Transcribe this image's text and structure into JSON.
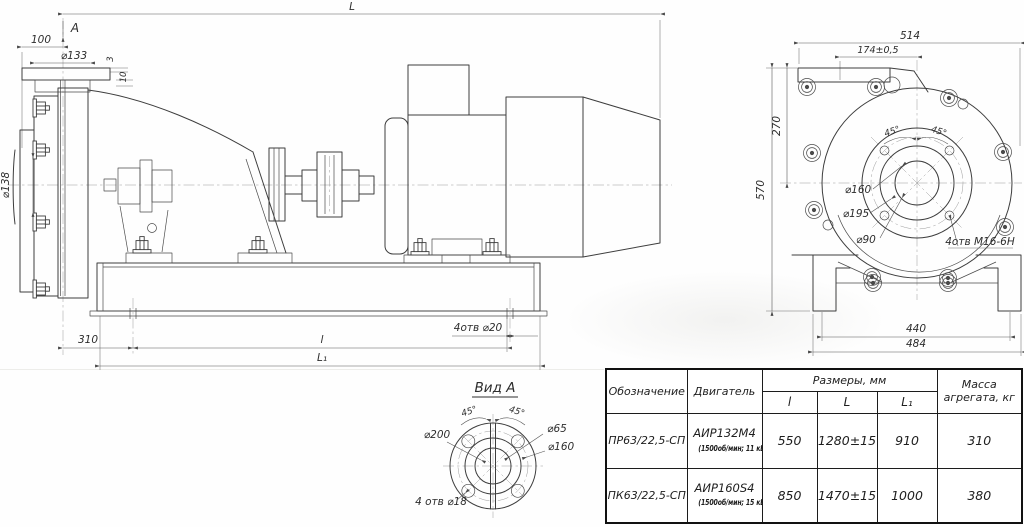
{
  "side_view": {
    "dim_L": "L",
    "view_arrow_label": "А",
    "dim_100": "100",
    "dim_d133": "⌀133",
    "dim_3": "3",
    "dim_10": "10",
    "dim_d138": "⌀138",
    "dim_310": "310",
    "dim_l": "l",
    "dim_L1": "L₁",
    "dim_holes": "4отв ⌀20"
  },
  "front_view": {
    "dim_514": "514",
    "dim_174": "174±0,5",
    "dim_270": "270",
    "dim_570": "570",
    "dim_440": "440",
    "dim_484": "484",
    "dim_d160": "⌀160",
    "dim_d195": "⌀195",
    "dim_d90": "⌀90",
    "dim_45_left": "45°",
    "dim_45_right": "45°",
    "dim_holes": "4отв М16-6Н"
  },
  "view_a": {
    "title": "Вид А",
    "dim_45_left": "45°",
    "dim_45_right": "45°",
    "dim_d200": "⌀200",
    "dim_d65": "⌀65",
    "dim_d160": "⌀160",
    "dim_holes": "4 отв ⌀18"
  },
  "table": {
    "col_designation": "Обозначение",
    "col_motor": "Двигатель",
    "col_dimensions": "Размеры, мм",
    "col_l": "l",
    "col_L": "L",
    "col_L1": "L₁",
    "col_mass_line1": "Масса",
    "col_mass_line2": "агрегата, кг",
    "rows": [
      {
        "designation": "ПР63/22,5-СП",
        "motor": "АИР132М4",
        "motor_spec": "(1500об/мин; 11 кВт)",
        "l": "550",
        "L": "1280±15",
        "L1": "910",
        "mass": "310"
      },
      {
        "designation": "ПК63/22,5-СП",
        "motor": "АИР160S4",
        "motor_spec": "(1500об/мин; 15 кВт)",
        "l": "850",
        "L": "1470±15",
        "L1": "1000",
        "mass": "380"
      }
    ]
  }
}
